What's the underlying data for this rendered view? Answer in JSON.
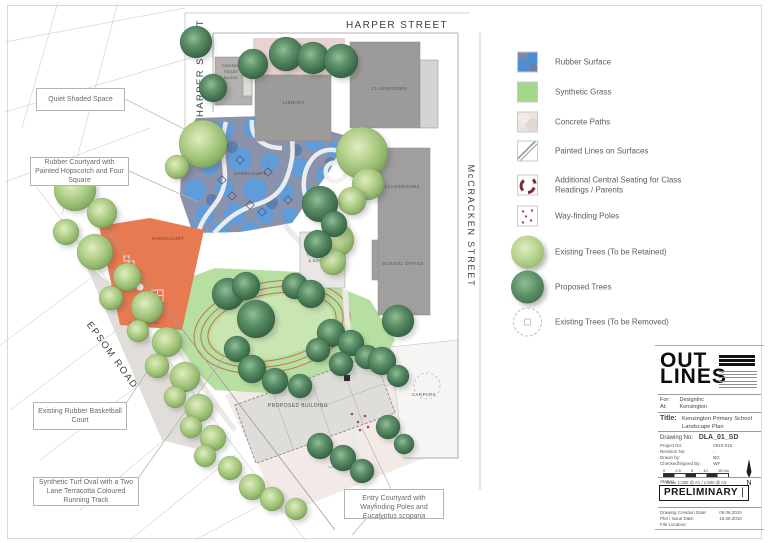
{
  "colors": {
    "rubber_blue_circle": "#5a9ede",
    "rubber_base": "#8a92ac",
    "synthetic_grass": "#b8dfa2",
    "hardcourt_orange": "#e87a52",
    "track_terracotta": "#bf7350",
    "building_grey": "#a09f9d",
    "tree_existing": "#a9cc83",
    "tree_proposed": "#4a7d58"
  },
  "plan": {
    "labels": [
      {
        "id": "harper-street-top",
        "t": "HARPER STREET",
        "x": 397,
        "y": 28,
        "s": 10,
        "r": 0,
        "ls": 1.4,
        "c": "#3d3d3d"
      },
      {
        "id": "harper-street-left",
        "t": "HARPER STREET",
        "x": 203,
        "y": 68,
        "s": 9.5,
        "r": -90,
        "ls": 1.4,
        "c": "#3d3d3d"
      },
      {
        "id": "mccracken-street",
        "t": "McCRACKEN  STREET",
        "x": 468,
        "y": 226,
        "s": 9,
        "r": 90,
        "ls": 1.8,
        "c": "#3d3d3d"
      },
      {
        "id": "epsom-road",
        "t": "EPSOM ROAD",
        "x": 110,
        "y": 357,
        "s": 9.5,
        "r": 54,
        "ls": 1.6,
        "c": "#3d3d3d"
      },
      {
        "id": "playground-top",
        "t": "PLAYGROUND",
        "x": 292,
        "y": 46,
        "s": 4,
        "r": 0,
        "ls": 0.3,
        "c": "#96807d"
      },
      {
        "id": "disused-1",
        "t": "DISUSED",
        "x": 231,
        "y": 67,
        "s": 3.8,
        "r": 0,
        "ls": 0.2,
        "c": "#4c4c4c"
      },
      {
        "id": "disused-2",
        "t": "TOILET",
        "x": 231,
        "y": 73,
        "s": 3.8,
        "r": 0,
        "ls": 0.2,
        "c": "#4c4c4c"
      },
      {
        "id": "disused-3",
        "t": "BLOCK",
        "x": 231,
        "y": 79,
        "s": 3.8,
        "r": 0,
        "ls": 0.2,
        "c": "#4c4c4c"
      },
      {
        "id": "library",
        "t": "LIBRARY",
        "x": 294,
        "y": 104,
        "s": 4.5,
        "r": 0,
        "ls": 0.4,
        "c": "#555555"
      },
      {
        "id": "classrooms-top",
        "t": "CLASSROOMS",
        "x": 389,
        "y": 90,
        "s": 4.5,
        "r": 0,
        "ls": 0.4,
        "c": "#555555"
      },
      {
        "id": "classrooms-right",
        "t": "CLASSROOMS",
        "x": 402,
        "y": 188,
        "s": 4.5,
        "r": 0,
        "ls": 0.4,
        "c": "#555555"
      },
      {
        "id": "school-office",
        "t": "SCHOOL OFFICE",
        "x": 403,
        "y": 265,
        "s": 4.5,
        "r": 0,
        "ls": 0.4,
        "c": "#555555"
      },
      {
        "id": "toilet-kitchen-1",
        "t": "TOILET BLOCK",
        "x": 322,
        "y": 256,
        "s": 4,
        "r": 0,
        "ls": 0.2,
        "c": "#555555"
      },
      {
        "id": "toilet-kitchen-2",
        "t": "& KITCHEN",
        "x": 320,
        "y": 262,
        "s": 4,
        "r": 0,
        "ls": 0.2,
        "c": "#555555"
      },
      {
        "id": "hardcourt-rubber",
        "t": "HARDCOURT",
        "x": 250,
        "y": 175,
        "s": 4.5,
        "r": 0,
        "ls": 0.4,
        "c": "#4e4e5e"
      },
      {
        "id": "hardcourt-orange",
        "t": "HARDCOURT",
        "x": 168,
        "y": 240,
        "s": 4.5,
        "r": 0,
        "ls": 0.4,
        "c": "#6e4636"
      },
      {
        "id": "playground-left",
        "t": "PLAYGROUND",
        "x": 144,
        "y": 324,
        "s": 4,
        "r": 0,
        "ls": 0.3,
        "c": "#6a6a6a"
      },
      {
        "id": "proposed-building",
        "t": "PROPOSED BUILDING",
        "x": 298,
        "y": 407,
        "s": 5,
        "r": 0,
        "ls": 0.4,
        "c": "#4f4f4f"
      },
      {
        "id": "carpark",
        "t": "CARPARK",
        "x": 424,
        "y": 396,
        "s": 4.5,
        "r": 0,
        "ls": 0.4,
        "c": "#555555"
      }
    ],
    "trees": [
      [
        "p",
        196,
        42,
        16
      ],
      [
        "p",
        213,
        88,
        14
      ],
      [
        "p",
        253,
        64,
        15
      ],
      [
        "p",
        286,
        54,
        17
      ],
      [
        "p",
        313,
        58,
        16
      ],
      [
        "p",
        341,
        61,
        17
      ],
      [
        "e",
        203,
        144,
        24
      ],
      [
        "e",
        177,
        167,
        12
      ],
      [
        "e",
        362,
        153,
        26
      ],
      [
        "e",
        368,
        184,
        16
      ],
      [
        "e",
        352,
        201,
        14
      ],
      [
        "e",
        337,
        240,
        17
      ],
      [
        "e",
        333,
        262,
        13
      ],
      [
        "p",
        320,
        204,
        18
      ],
      [
        "p",
        334,
        224,
        13
      ],
      [
        "p",
        318,
        244,
        14
      ],
      [
        "p",
        398,
        321,
        16
      ],
      [
        "e",
        75,
        190,
        21
      ],
      [
        "e",
        102,
        213,
        15
      ],
      [
        "e",
        66,
        232,
        13
      ],
      [
        "e",
        95,
        252,
        18
      ],
      [
        "e",
        127,
        277,
        14
      ],
      [
        "e",
        111,
        298,
        12
      ],
      [
        "e",
        147,
        307,
        16
      ],
      [
        "e",
        138,
        331,
        11
      ],
      [
        "e",
        167,
        342,
        15
      ],
      [
        "e",
        157,
        366,
        12
      ],
      [
        "e",
        185,
        377,
        15
      ],
      [
        "e",
        175,
        397,
        11
      ],
      [
        "e",
        199,
        408,
        14
      ],
      [
        "e",
        191,
        427,
        11
      ],
      [
        "e",
        213,
        438,
        13
      ],
      [
        "e",
        205,
        456,
        11
      ],
      [
        "e",
        230,
        468,
        12
      ],
      [
        "e",
        252,
        487,
        13
      ],
      [
        "e",
        272,
        499,
        12
      ],
      [
        "e",
        296,
        509,
        11
      ],
      [
        "p",
        228,
        294,
        16
      ],
      [
        "p",
        246,
        286,
        14
      ],
      [
        "p",
        295,
        286,
        13
      ],
      [
        "p",
        311,
        294,
        14
      ],
      [
        "p",
        256,
        319,
        19
      ],
      [
        "p",
        237,
        349,
        13
      ],
      [
        "p",
        252,
        369,
        14
      ],
      [
        "p",
        275,
        381,
        13
      ],
      [
        "p",
        300,
        386,
        12
      ],
      [
        "p",
        331,
        333,
        14
      ],
      [
        "p",
        351,
        343,
        13
      ],
      [
        "p",
        367,
        357,
        12
      ],
      [
        "p",
        341,
        364,
        12
      ],
      [
        "p",
        318,
        350,
        12
      ],
      [
        "p",
        382,
        361,
        14
      ],
      [
        "p",
        398,
        376,
        11
      ],
      [
        "p",
        320,
        446,
        13
      ],
      [
        "p",
        343,
        458,
        13
      ],
      [
        "p",
        362,
        471,
        12
      ],
      [
        "p",
        388,
        427,
        12
      ],
      [
        "p",
        404,
        444,
        10
      ],
      [
        "r",
        427,
        386,
        13
      ]
    ]
  },
  "annotations": [
    {
      "text": "Quiet Shaded Space"
    },
    {
      "text": "Rubber Courtyard with Painted Hopscotch and Four Square"
    },
    {
      "text": "Existing Rubber Basketball Court"
    },
    {
      "text": "Synthetic Turf Oval with a Two Lane Terracotta Coloured Running Track"
    },
    {
      "text": "Entry Courtyard with Wayfinding Poles and ",
      "italic": "Eucalyptus scoparia"
    }
  ],
  "legend": {
    "items": [
      {
        "label": "Rubber Surface"
      },
      {
        "label": "Synthetic Grass"
      },
      {
        "label": "Concrete Paths"
      },
      {
        "label": "Painted Lines on Surfaces"
      },
      {
        "label": "Additional Central Seating for Class Readings / Parents"
      },
      {
        "label": "Way-finding Poles"
      },
      {
        "label": "Existing Trees (To be Retained)"
      },
      {
        "label": "Proposed Trees"
      },
      {
        "label": "Existing Trees (To be Removed)"
      }
    ]
  },
  "title_block": {
    "logo_line1": "OUT",
    "logo_line2": "LINES",
    "for_label": "For:",
    "for_value": "DesignInc",
    "at_label": "At:",
    "at_value": "Kensington",
    "title_label": "Title:",
    "title_value_1": "Kensington Primary School",
    "title_value_2": "Landscape Plan",
    "drawing_no_label": "Drawing No:",
    "drawing_no_value": "DLA_01_SD",
    "project_no_label": "Project No:",
    "project_no_value": "0910-010",
    "revision_label": "Revision No:",
    "revision_value": "-",
    "drawn_label": "Drawn by:",
    "drawn_value": "BG",
    "checked_label": "Checked/Signed By:",
    "checked_value": "WF",
    "scale_ticks": [
      "0",
      "2.5",
      "5",
      "10",
      "15.0m"
    ],
    "scale_text": "Scale 1:250 @ A1 / 1:500 @ A3",
    "north_label": "N",
    "status_label": "Status:",
    "status_value": "PRELIMINARY",
    "status_suffix": "|",
    "created_label": "Drawing Creation Date:",
    "created_value": "09.06.2010",
    "issue_label": "Plot / Issue Date:",
    "issue_value": "16.06.2010",
    "file_label": "File Location:"
  }
}
